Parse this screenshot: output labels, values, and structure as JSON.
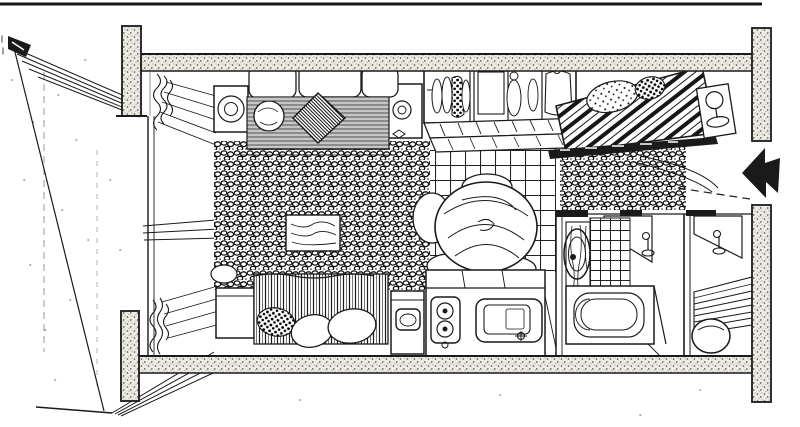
{
  "meta": {
    "title": "Hand-drawn ink floor plan sketch of a compact studio apartment, top-down axonometric view",
    "medium": "black pen-and-ink line drawing on white paper"
  },
  "colors": {
    "paper": "#ffffff",
    "ink": "#1a1a1a",
    "wall_tint": "#edeae3"
  },
  "entrance": {
    "arrow_direction": "left"
  },
  "rooms": [
    "balcony-deck",
    "living-area",
    "sleeping-alcove",
    "dining-area",
    "kitchen",
    "bathroom",
    "utility-room",
    "entry"
  ],
  "objects": [
    "concrete-wall-bands-with-stipple",
    "corner-columns",
    "balcony-roof-planks",
    "balcony-deck-planks",
    "window-wall-with-curtains",
    "sofa-with-back-cushions",
    "striped-sofa-seat",
    "round-pillow",
    "hatched-diamond-pillow",
    "side-tables-with-lamps",
    "shag-rug",
    "low-table",
    "open-wardrobe-with-hanging-clothes",
    "storage-bench",
    "diagonal-striped-double-bed",
    "speckled-pillows",
    "bedside-lamp",
    "pebble-rug",
    "checkered-tile-floor",
    "round-wood-dining-table",
    "dining-chairs",
    "washbasin-cabinet",
    "kitchen-counter",
    "two-burner-cooktop",
    "kitchen-sink-with-faucet",
    "single-bed-vertical-stripes",
    "nightstand",
    "bathroom-door-with-handle",
    "round-wall-mirror",
    "tiled-bath-wall",
    "bathtub",
    "utility-door-with-handle",
    "slatted-floor-mat",
    "round-stool",
    "entrance-arrow"
  ]
}
